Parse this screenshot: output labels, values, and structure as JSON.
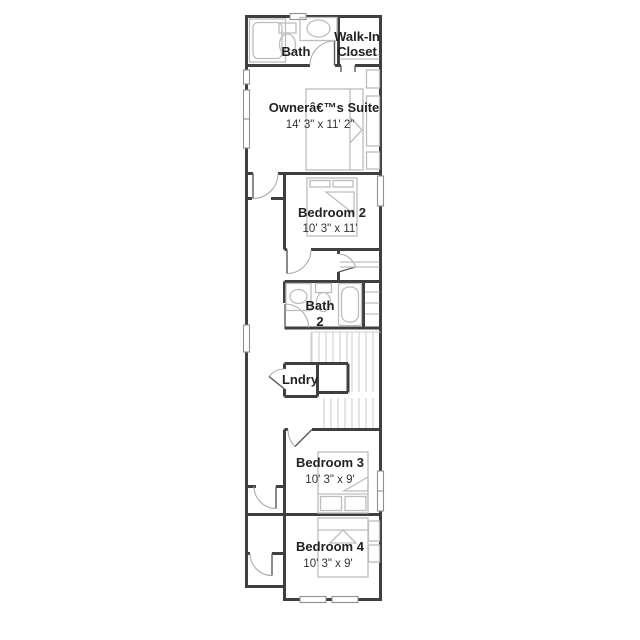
{
  "plan": {
    "rooms": {
      "bath": {
        "label": "Bath"
      },
      "walk_in_closet": {
        "line1": "Walk-In",
        "line2": "Closet"
      },
      "owners_suite": {
        "label": "Ownerâ€™s Suite",
        "dims": "14' 3\" x 11' 2\""
      },
      "bedroom2": {
        "label": "Bedroom 2",
        "dims": "10' 3\" x 11'"
      },
      "bath2": {
        "line1": "Bath",
        "line2": "2"
      },
      "laundry": {
        "label": "Lndry"
      },
      "bedroom3": {
        "label": "Bedroom 3",
        "dims": "10' 3\" x 9'"
      },
      "bedroom4": {
        "label": "Bedroom 4",
        "dims": "10' 3\" x 9'"
      }
    },
    "colors": {
      "wall": "#3f3f3f",
      "fixture": "#bdbdbd",
      "stair": "#cfcfcf",
      "door_arc": "#adadad",
      "text": "#222222",
      "background": "#ffffff"
    }
  }
}
